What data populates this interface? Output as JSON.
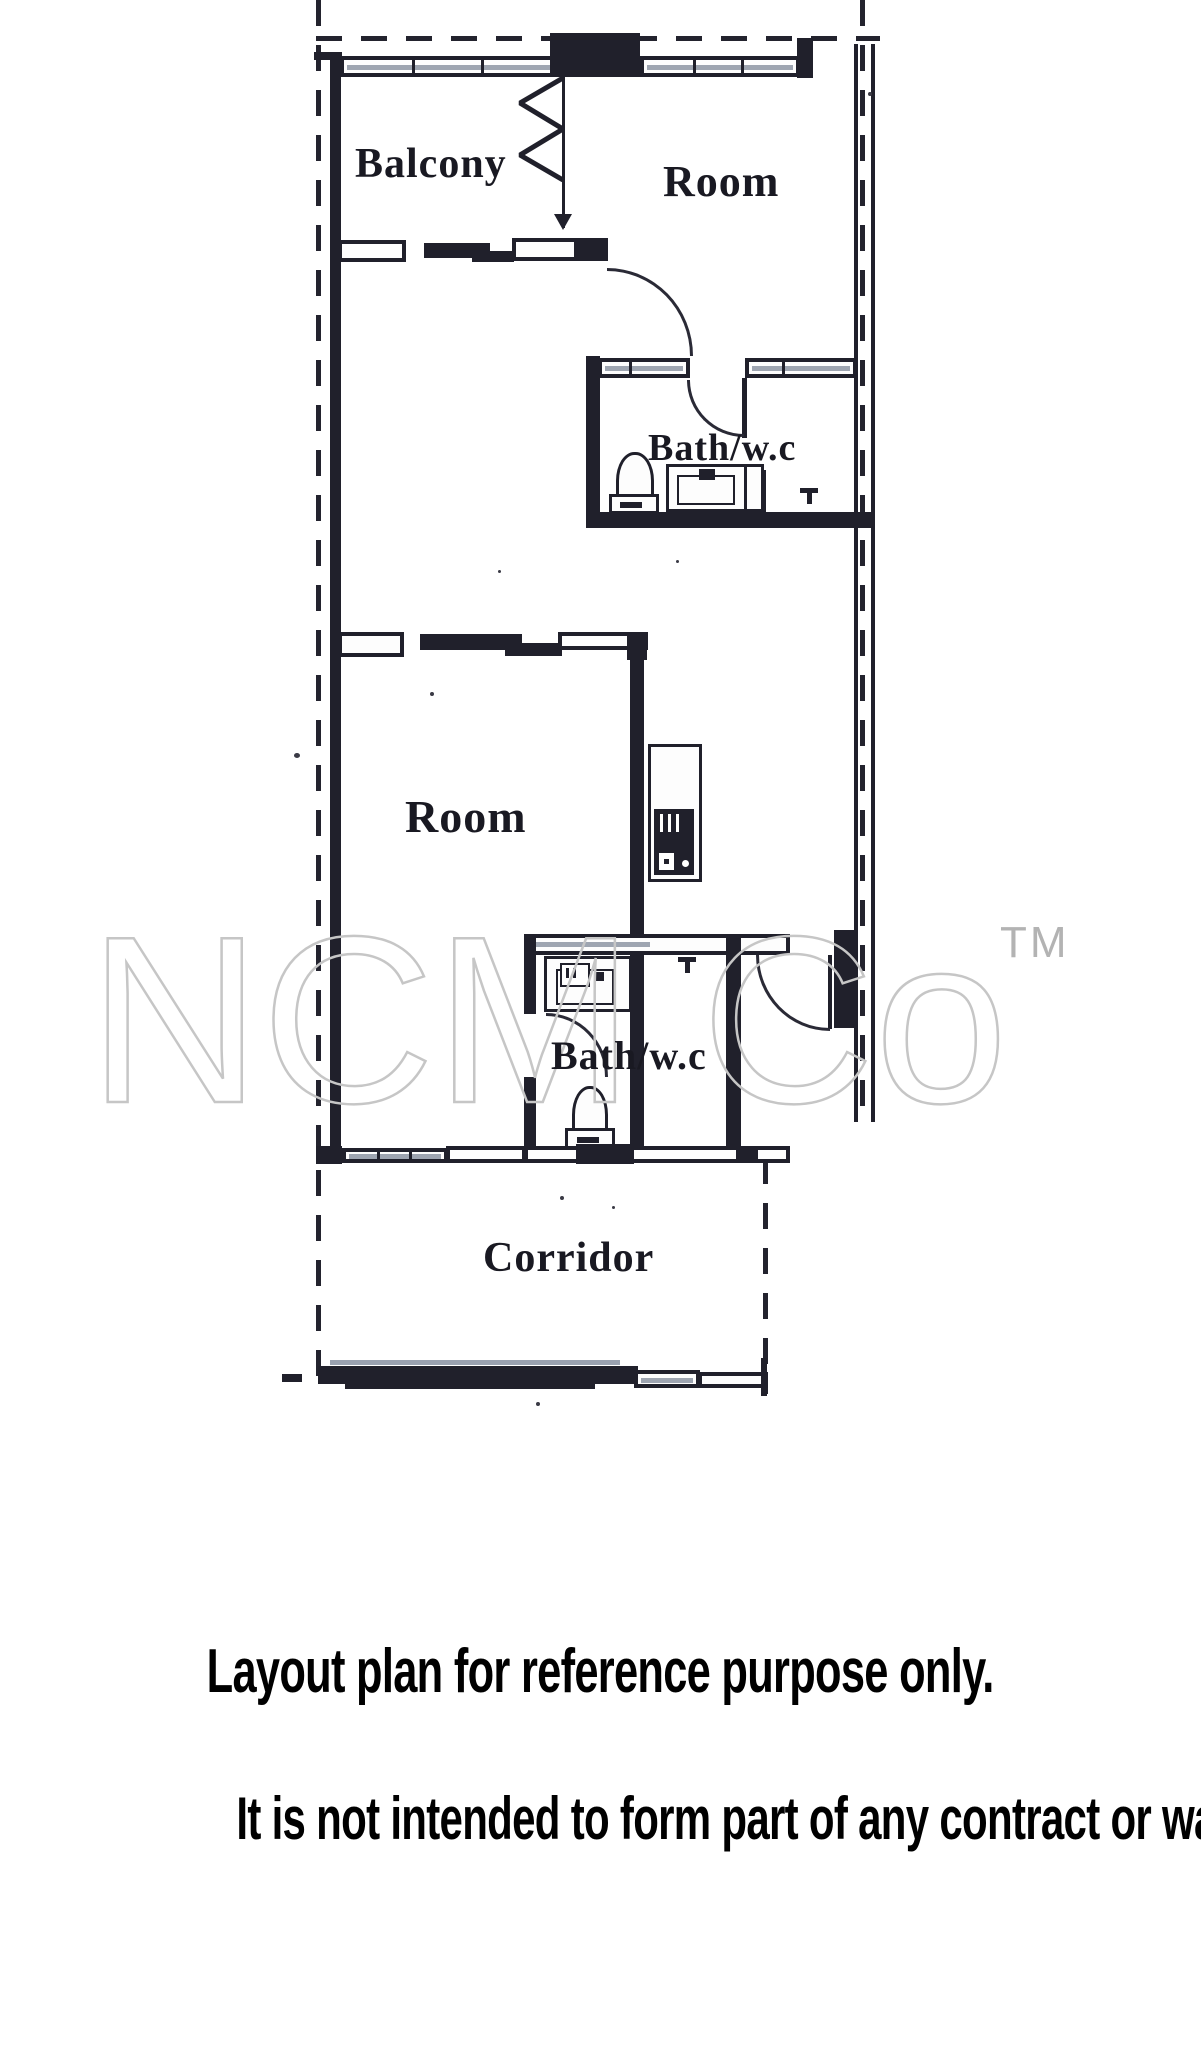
{
  "plan": {
    "labels": {
      "balcony": "Balcony",
      "room_top": "Room",
      "bath_top": "Bath/w.c",
      "room_mid": "Room",
      "bath_bottom": "Bath/w.c",
      "corridor": "Corridor"
    },
    "watermark": {
      "text": "NCM Co",
      "tm": "TM"
    },
    "colors": {
      "ink": "#20202b",
      "watermark": "#c6c6c6",
      "window_sill": "#8d95a3"
    }
  },
  "footer": {
    "line1": "Layout plan for reference purpose only.",
    "line2": "It is not intended to form part of any contract or warranty."
  }
}
